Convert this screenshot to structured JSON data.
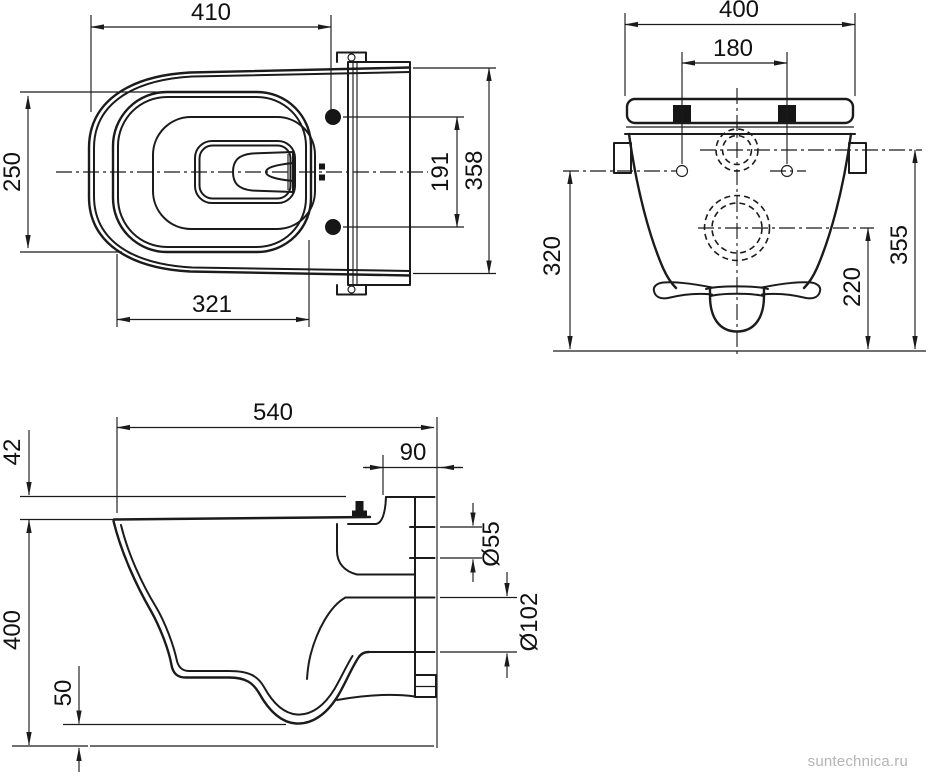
{
  "drawing": {
    "line_color": "#1b1b1b",
    "background": "#ffffff"
  },
  "top_view": {
    "dims": {
      "overall_length": "410",
      "seat_opening_width": "250",
      "opening_length": "321",
      "bolt_spacing": "191",
      "overall_width": "358"
    }
  },
  "rear_view": {
    "dims": {
      "overall_width": "400",
      "fixing_bolt_spacing": "180",
      "fixing_hole_height": "320",
      "outlet_height": "220",
      "inlet_height": "355"
    }
  },
  "side_view": {
    "dims": {
      "overall_depth": "540",
      "seat_step_height": "42",
      "rear_recess_depth": "90",
      "overall_height": "400",
      "bottom_clearance": "50",
      "inlet_diameter": "Ø55",
      "outlet_diameter": "Ø102"
    }
  },
  "watermark": {
    "text": "suntechnica.ru",
    "color": "#b4b4b4"
  }
}
